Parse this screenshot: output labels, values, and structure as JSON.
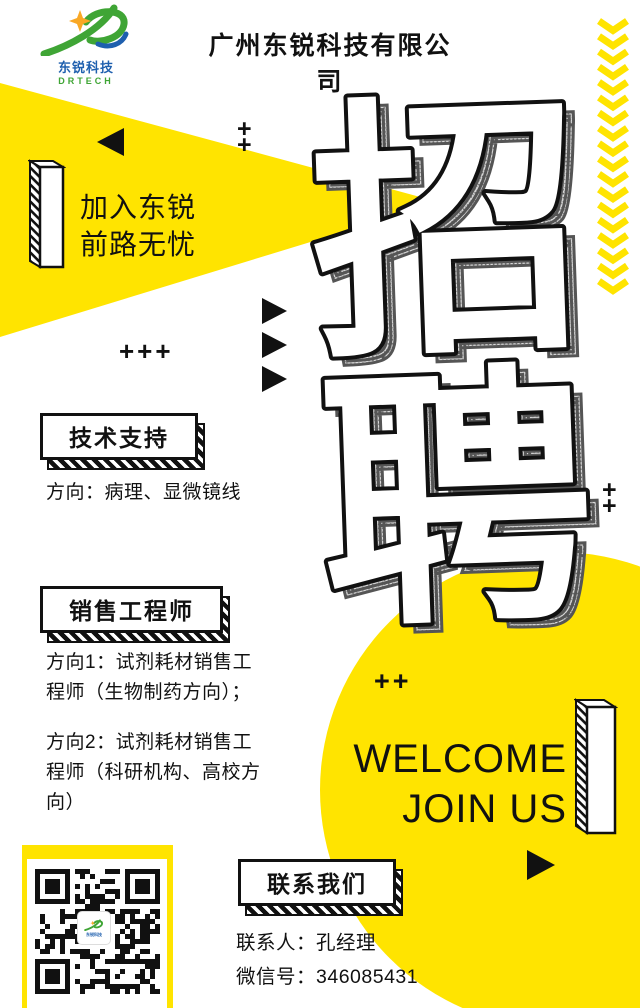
{
  "brand": {
    "logo_text_cn": "东锐科技",
    "logo_text_en": "DRTECH",
    "company_name": "广州东锐科技有限公司",
    "colors": {
      "yellow": "#FFE400",
      "black": "#111111",
      "logo_green": "#3FA535",
      "logo_blue": "#1E5FAE",
      "star_orange": "#F9A825"
    }
  },
  "hero": {
    "slogan": [
      "加入东锐",
      "前路无忧"
    ],
    "title_chars": [
      "招",
      "聘"
    ],
    "welcome": [
      "WELCOME",
      "JOIN US"
    ]
  },
  "decor": {
    "plus": "+",
    "plus_row": "+++",
    "plus_pair": "++"
  },
  "sections": [
    {
      "title": "技术支持",
      "lines": [
        "方向：病理、显微镜线"
      ]
    },
    {
      "title": "销售工程师",
      "lines": [
        "方向1：试剂耗材销售工程师（生物制药方向）；",
        "方向2：试剂耗材销售工程师（科研机构、高校方向）"
      ]
    }
  ],
  "contact": {
    "title": "联系我们",
    "person_label": "联系人：",
    "person_name": "孔经理",
    "wechat_label": "微信号：",
    "wechat_id": "346085431"
  }
}
